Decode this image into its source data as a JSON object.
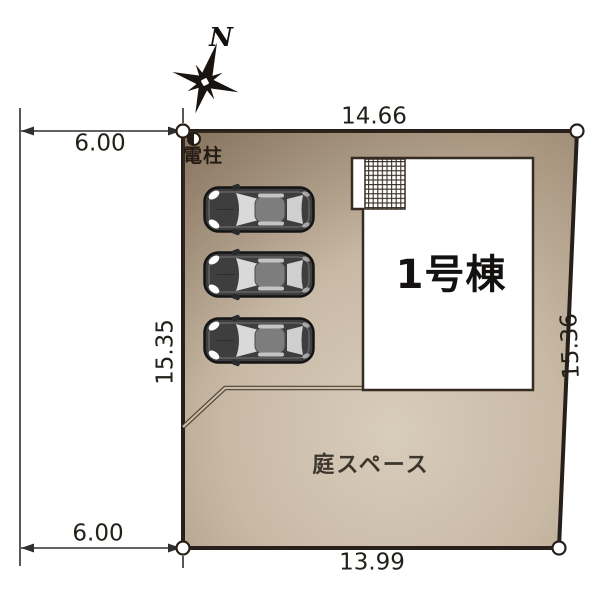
{
  "compass": {
    "north_label": "N"
  },
  "dimensions": {
    "top_width": "14.66",
    "bottom_width": "13.99",
    "left_depth": "15.35",
    "right_depth": "15.36",
    "road_offset_top": "6.00",
    "road_offset_bottom": "6.00"
  },
  "labels": {
    "utility_pole": "電柱",
    "building": "1号棟",
    "garden": "庭スペース"
  },
  "site": {
    "car_count": 3,
    "corner_marker_count": 4,
    "icons": [
      "compass-rose-icon",
      "utility-pole-icon",
      "car-icon",
      "corner-marker-icon",
      "balcony-hatch"
    ]
  },
  "colors": {
    "plot_fill_light": "#d8ccbb",
    "plot_fill_mid": "#c8b9a5",
    "plot_fill_dark": "#a28f79",
    "plot_border": "#27201a",
    "building_fill": "#ffffff",
    "building_border": "#352b22",
    "dimension_line": "#2f2f2f",
    "car_body": "#3e3e3e",
    "text": "#1f1f1f"
  }
}
